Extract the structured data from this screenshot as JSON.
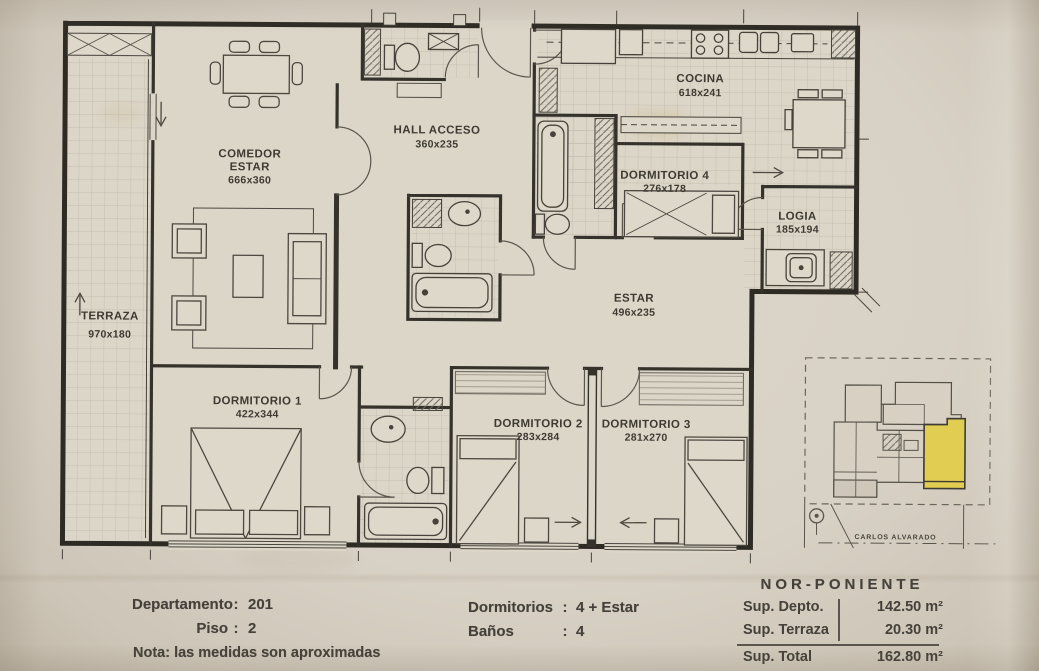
{
  "plan": {
    "rooms": {
      "comedor": {
        "name": "COMEDOR",
        "name2": "ESTAR",
        "dims": "666x360"
      },
      "hall": {
        "name": "HALL ACCESO",
        "dims": "360x235"
      },
      "cocina": {
        "name": "COCINA",
        "dims": "618x241"
      },
      "dorm4": {
        "name": "DORMITORIO 4",
        "dims": "276x178"
      },
      "logia": {
        "name": "LOGIA",
        "dims": "185x194"
      },
      "terraza": {
        "name": "TERRAZA",
        "dims": "970x180"
      },
      "estar": {
        "name": "ESTAR",
        "dims": "496x235"
      },
      "dorm1": {
        "name": "DORMITORIO 1",
        "dims": "422x344"
      },
      "dorm2": {
        "name": "DORMITORIO 2",
        "dims": "283x284"
      },
      "dorm3": {
        "name": "DORMITORIO 3",
        "dims": "281x270"
      }
    },
    "site": {
      "street": "CARLOS ALVARADO",
      "highlight_color": "#e0cd52"
    }
  },
  "info": {
    "departamento": {
      "label": "Departamento",
      "sep": ":",
      "value": "201"
    },
    "piso": {
      "label": "Piso",
      "sep": ":",
      "value": "2"
    },
    "nota": "Nota: las medidas son aproximadas",
    "dormitorios": {
      "label": "Dormitorios",
      "sep": ":",
      "value": "4 + Estar"
    },
    "banos": {
      "label": "Baños",
      "sep": ":",
      "value": "4"
    },
    "orientation": "NOR-PONIENTE",
    "superficies": {
      "rows": [
        {
          "label": "Sup. Depto.",
          "value": "142.50 m²"
        },
        {
          "label": "Sup. Terraza",
          "value": "20.30 m²"
        },
        {
          "label": "Sup. Total",
          "value": "162.80 m²"
        }
      ]
    }
  }
}
